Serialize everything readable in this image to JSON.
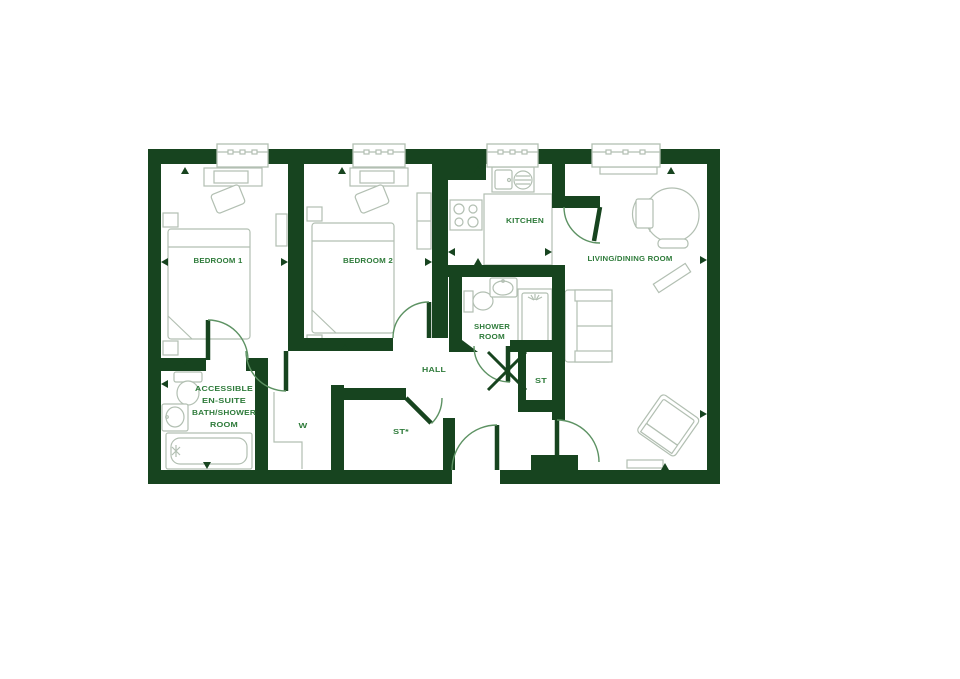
{
  "floorplan": {
    "type": "apartment-floor-plan",
    "rooms": {
      "bedroom1": {
        "label": "BEDROOM 1"
      },
      "bedroom2": {
        "label": "BEDROOM 2"
      },
      "kitchen": {
        "label": "KITCHEN"
      },
      "living": {
        "label": "LIVING/DINING ROOM"
      },
      "shower": {
        "line1": "SHOWER",
        "line2": "ROOM"
      },
      "hall": {
        "label": "HALL"
      },
      "store": {
        "label": "ST"
      },
      "store2": {
        "label": "ST*"
      },
      "wardrobe": {
        "label": "W"
      },
      "ensuite": {
        "line1": "ACCESSIBLE",
        "line2": "EN-SUITE",
        "line3": "BATH/SHOWER",
        "line4": "ROOM"
      }
    },
    "colors": {
      "wall": "#17441f",
      "label": "#2e7b3a",
      "furniture": "#b2bfb2",
      "door_arc": "#5d9263"
    }
  }
}
